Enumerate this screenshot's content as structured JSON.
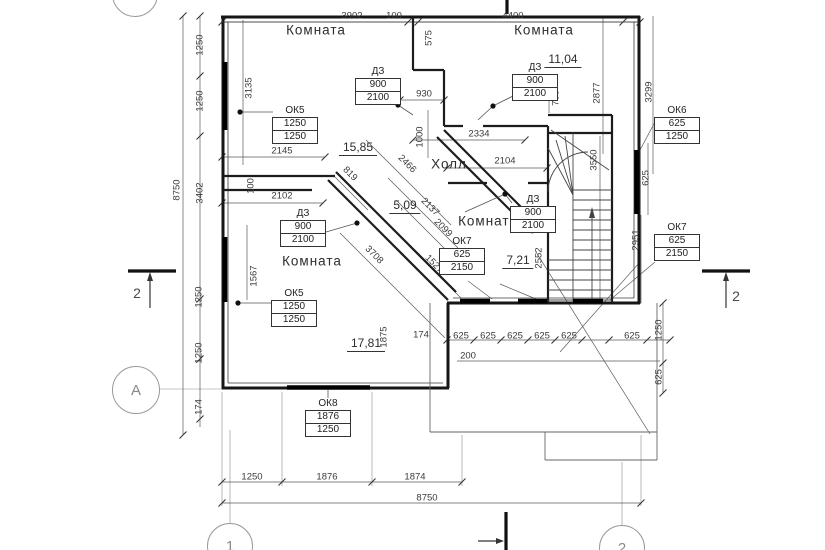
{
  "drawing": {
    "title": "Поэтажный план",
    "type": "floor-plan",
    "colors": {
      "lines": "#1c1c1c",
      "thin_lines": "#555555",
      "background": "#ffffff"
    },
    "rooms": [
      {
        "label": "Комната",
        "area": "15,85",
        "lx": 316,
        "ly": 30,
        "ax": 358,
        "ay": 148
      },
      {
        "label": "Комната",
        "area": "11,04",
        "lx": 544,
        "ly": 30,
        "ax": 563,
        "ay": 60
      },
      {
        "label": "Холл",
        "area": "5,09",
        "lx": 449,
        "ly": 164,
        "ax": 405,
        "ay": 206
      },
      {
        "label": "Комната",
        "area": "7,21",
        "lx": 488,
        "ly": 221,
        "ax": 518,
        "ay": 261
      },
      {
        "label": "Комната",
        "area": "17,81",
        "lx": 312,
        "ly": 261,
        "ax": 366,
        "ay": 344
      }
    ],
    "spec_blocks": [
      {
        "label": "ОК5",
        "rows": [
          "1250",
          "1250"
        ],
        "x": 295,
        "y": 105
      },
      {
        "label": "ДЗ",
        "rows": [
          "900",
          "2100"
        ],
        "x": 378,
        "y": 66
      },
      {
        "label": "ДЗ",
        "rows": [
          "900",
          "2100"
        ],
        "x": 535,
        "y": 62
      },
      {
        "label": "ОК6",
        "rows": [
          "625",
          "1250"
        ],
        "x": 677,
        "y": 105
      },
      {
        "label": "ДЗ",
        "rows": [
          "900",
          "2100"
        ],
        "x": 533,
        "y": 194
      },
      {
        "label": "ОК7",
        "rows": [
          "625",
          "2150"
        ],
        "x": 677,
        "y": 222
      },
      {
        "label": "ОК7",
        "rows": [
          "625",
          "2150"
        ],
        "x": 462,
        "y": 236
      },
      {
        "label": "ОК5",
        "rows": [
          "1250",
          "1250"
        ],
        "x": 294,
        "y": 288
      },
      {
        "label": "ДЗ",
        "rows": [
          "900",
          "2100"
        ],
        "x": 303,
        "y": 208
      },
      {
        "label": "ОК8",
        "rows": [
          "1876",
          "1250"
        ],
        "x": 328,
        "y": 398
      }
    ],
    "dimensions": [
      {
        "t": "3902",
        "x": 352,
        "y": 16,
        "r": 0
      },
      {
        "t": "100",
        "x": 394,
        "y": 16,
        "r": 0
      },
      {
        "t": "4400",
        "x": 513,
        "y": 16,
        "r": 0
      },
      {
        "t": "575",
        "x": 429,
        "y": 38,
        "r": 90
      },
      {
        "t": "2877",
        "x": 597,
        "y": 93,
        "r": 90
      },
      {
        "t": "3299",
        "x": 649,
        "y": 92,
        "r": 90
      },
      {
        "t": "930",
        "x": 424,
        "y": 94,
        "r": 0
      },
      {
        "t": "1000",
        "x": 420,
        "y": 137,
        "r": 90
      },
      {
        "t": "700",
        "x": 556,
        "y": 98,
        "r": 90
      },
      {
        "t": "2334",
        "x": 479,
        "y": 134,
        "r": 0
      },
      {
        "t": "2104",
        "x": 505,
        "y": 161,
        "r": 0
      },
      {
        "t": "2145",
        "x": 282,
        "y": 151,
        "r": 0
      },
      {
        "t": "100",
        "x": 251,
        "y": 186,
        "r": 90
      },
      {
        "t": "2102",
        "x": 282,
        "y": 196,
        "r": 0
      },
      {
        "t": "819",
        "x": 350,
        "y": 174,
        "r": 45
      },
      {
        "t": "2466",
        "x": 407,
        "y": 164,
        "r": 45
      },
      {
        "t": "2137",
        "x": 430,
        "y": 207,
        "r": 45
      },
      {
        "t": "2099",
        "x": 443,
        "y": 228,
        "r": 45
      },
      {
        "t": "3708",
        "x": 374,
        "y": 255,
        "r": 45
      },
      {
        "t": "1527",
        "x": 434,
        "y": 264,
        "r": 45
      },
      {
        "t": "2552",
        "x": 539,
        "y": 258,
        "r": 90
      },
      {
        "t": "3550",
        "x": 594,
        "y": 160,
        "r": 90
      },
      {
        "t": "625",
        "x": 646,
        "y": 178,
        "r": 90
      },
      {
        "t": "2951",
        "x": 636,
        "y": 240,
        "r": 90
      },
      {
        "t": "1567",
        "x": 254,
        "y": 276,
        "r": 90
      },
      {
        "t": "1875",
        "x": 384,
        "y": 337,
        "r": 90
      },
      {
        "t": "174",
        "x": 421,
        "y": 335,
        "r": 0
      },
      {
        "t": "625",
        "x": 461,
        "y": 336,
        "r": 0
      },
      {
        "t": "625",
        "x": 488,
        "y": 336,
        "r": 0
      },
      {
        "t": "625",
        "x": 515,
        "y": 336,
        "r": 0
      },
      {
        "t": "625",
        "x": 542,
        "y": 336,
        "r": 0
      },
      {
        "t": "625",
        "x": 569,
        "y": 336,
        "r": 0
      },
      {
        "t": "625",
        "x": 632,
        "y": 336,
        "r": 0
      },
      {
        "t": "200",
        "x": 468,
        "y": 356,
        "r": 0
      },
      {
        "t": "1250",
        "x": 659,
        "y": 330,
        "r": 90
      },
      {
        "t": "625",
        "x": 659,
        "y": 377,
        "r": 90
      },
      {
        "t": "8750",
        "x": 177,
        "y": 190,
        "r": 90
      },
      {
        "t": "3135",
        "x": 249,
        "y": 88,
        "r": 90
      },
      {
        "t": "1250",
        "x": 200,
        "y": 45,
        "r": 90
      },
      {
        "t": "1250",
        "x": 200,
        "y": 101,
        "r": 90
      },
      {
        "t": "3402",
        "x": 200,
        "y": 193,
        "r": 90
      },
      {
        "t": "1250",
        "x": 199,
        "y": 297,
        "r": 90
      },
      {
        "t": "1250",
        "x": 199,
        "y": 353,
        "r": 90
      },
      {
        "t": "174",
        "x": 199,
        "y": 407,
        "r": 90
      },
      {
        "t": "1250",
        "x": 252,
        "y": 477,
        "r": 0
      },
      {
        "t": "1876",
        "x": 327,
        "y": 477,
        "r": 0
      },
      {
        "t": "1874",
        "x": 415,
        "y": 477,
        "r": 0
      },
      {
        "t": "8750",
        "x": 427,
        "y": 498,
        "r": 0
      }
    ],
    "axis_markers": [
      {
        "label": "Б",
        "x": 135,
        "y": -6,
        "rad": 22
      },
      {
        "label": "А",
        "x": 136,
        "y": 390,
        "rad": 23
      },
      {
        "label": "1",
        "x": 230,
        "y": 546,
        "rad": 22
      },
      {
        "label": "2",
        "x": 622,
        "y": 548,
        "rad": 22
      }
    ],
    "section_markers": [
      {
        "label": "2",
        "x": 137,
        "y": 293
      },
      {
        "label": "2",
        "x": 736,
        "y": 296
      }
    ]
  }
}
